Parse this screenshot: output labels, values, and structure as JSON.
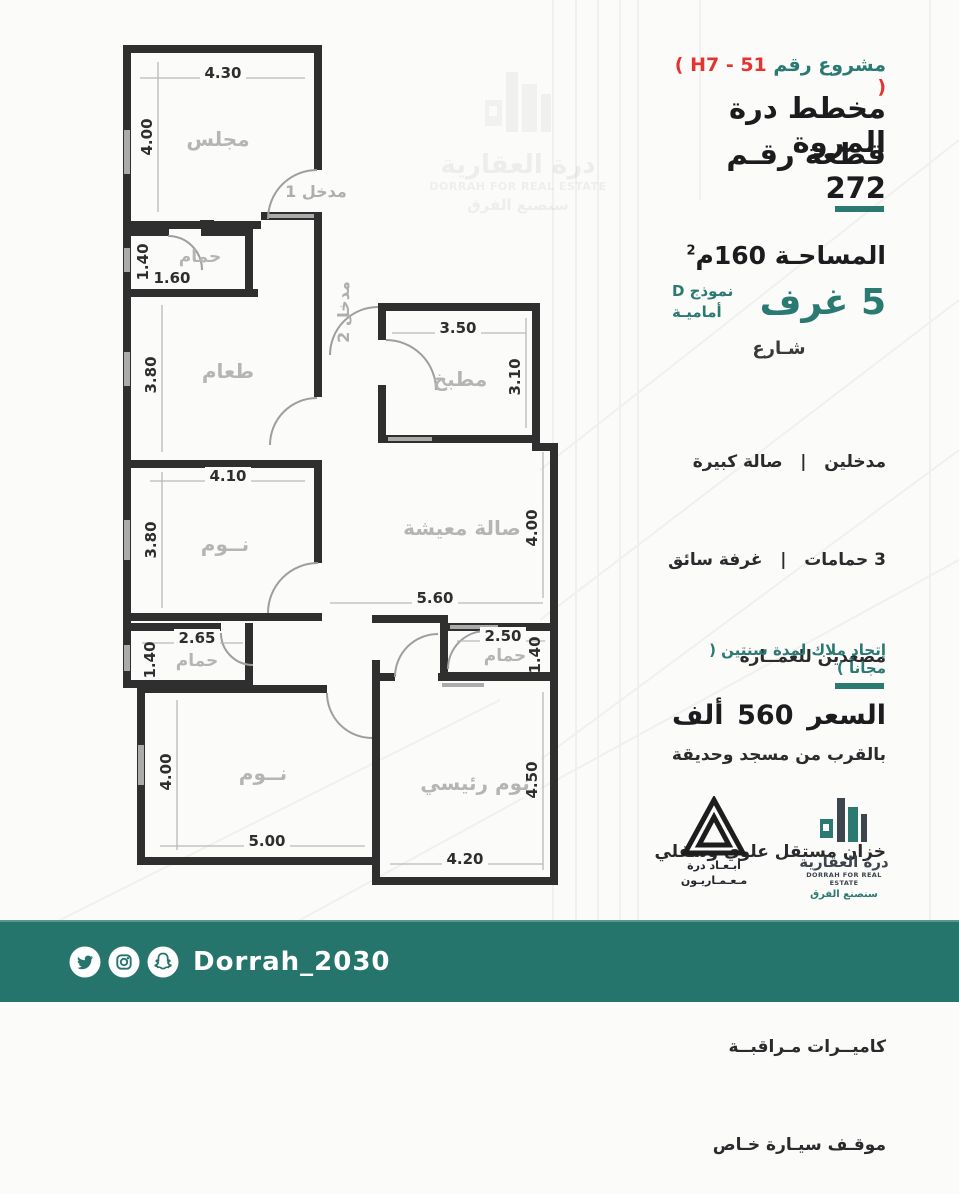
{
  "colors": {
    "teal": "#2a7a71",
    "footer_teal": "#26756c",
    "red": "#e5342f",
    "ink": "#1c1c1e",
    "room_gray": "#b5b5b5"
  },
  "header": {
    "project_label": "مشروع رقم",
    "project_code": "( H7 - 51 )",
    "title_line1": "مخطط درة المروة",
    "title_line2": "قطعة رقـم 272"
  },
  "specs": {
    "area_label": "المساحـة 160م",
    "area_sup": "2",
    "rooms": "5 غرف",
    "model_line1": "نموذج D",
    "model_line2": "أماميـة",
    "street": "شـارع"
  },
  "features": [
    "مدخلين   |   صالة كبيرة",
    "3 حمامات   |   غرفة سائق",
    "مصعدين للعمــارة",
    "بالقرب من مسجد وحديقة",
    "خزان مستقل علوي وسفلي",
    "غــاز مركـزي لكل شقة",
    "كاميــرات مـراقبــة",
    "موقـف سيـارة خـاص"
  ],
  "note": "إتحاد ملاك لمدة سنتين ( مجاناً )",
  "price": {
    "label": "السعر",
    "value": "560",
    "unit": "ألف"
  },
  "plan": {
    "rooms": {
      "majlis": "مجلس",
      "entrance1": "مدخل 1",
      "bath_top": "حمام",
      "dining": "طعام",
      "entrance2": "مدخل 2",
      "kitchen": "مطبخ",
      "bedroom_mid": "نــوم",
      "living": "صالة معيشة",
      "bath_left": "حمام",
      "bath_right": "حمام",
      "bedroom_bottom": "نــوم",
      "master": "نوم رئيسي"
    },
    "dims": {
      "majlis_w": "4.30",
      "majlis_h": "4.00",
      "bath_top_h": "1.40",
      "bath_top_w": "1.60",
      "dining_h": "3.80",
      "kitchen_w": "3.50",
      "kitchen_h": "3.10",
      "bedroom_mid_w": "4.10",
      "bedroom_mid_h": "3.80",
      "living_h": "4.00",
      "living_w": "5.60",
      "bath_left_w": "2.65",
      "bath_left_h": "1.40",
      "bath_right_w": "2.50",
      "bath_right_h": "1.40",
      "bedroom_bottom_h": "4.00",
      "bedroom_bottom_w": "5.00",
      "master_h": "4.50",
      "master_w": "4.20"
    }
  },
  "logos": {
    "abaad": {
      "line1": "أبـعـاد درة",
      "line2": "مـعـمـاريـون"
    },
    "dorrah": {
      "name_ar": "درة العقارية",
      "name_en": "DORRAH FOR REAL ESTATE",
      "tagline": "سنصنع الفرق"
    }
  },
  "watermark": {
    "name_ar": "درة العقارية",
    "name_en": "DORRAH FOR REAL ESTATE",
    "tagline": "سنصنع الفرق"
  },
  "footer": {
    "handle": "Dorrah_2030"
  }
}
